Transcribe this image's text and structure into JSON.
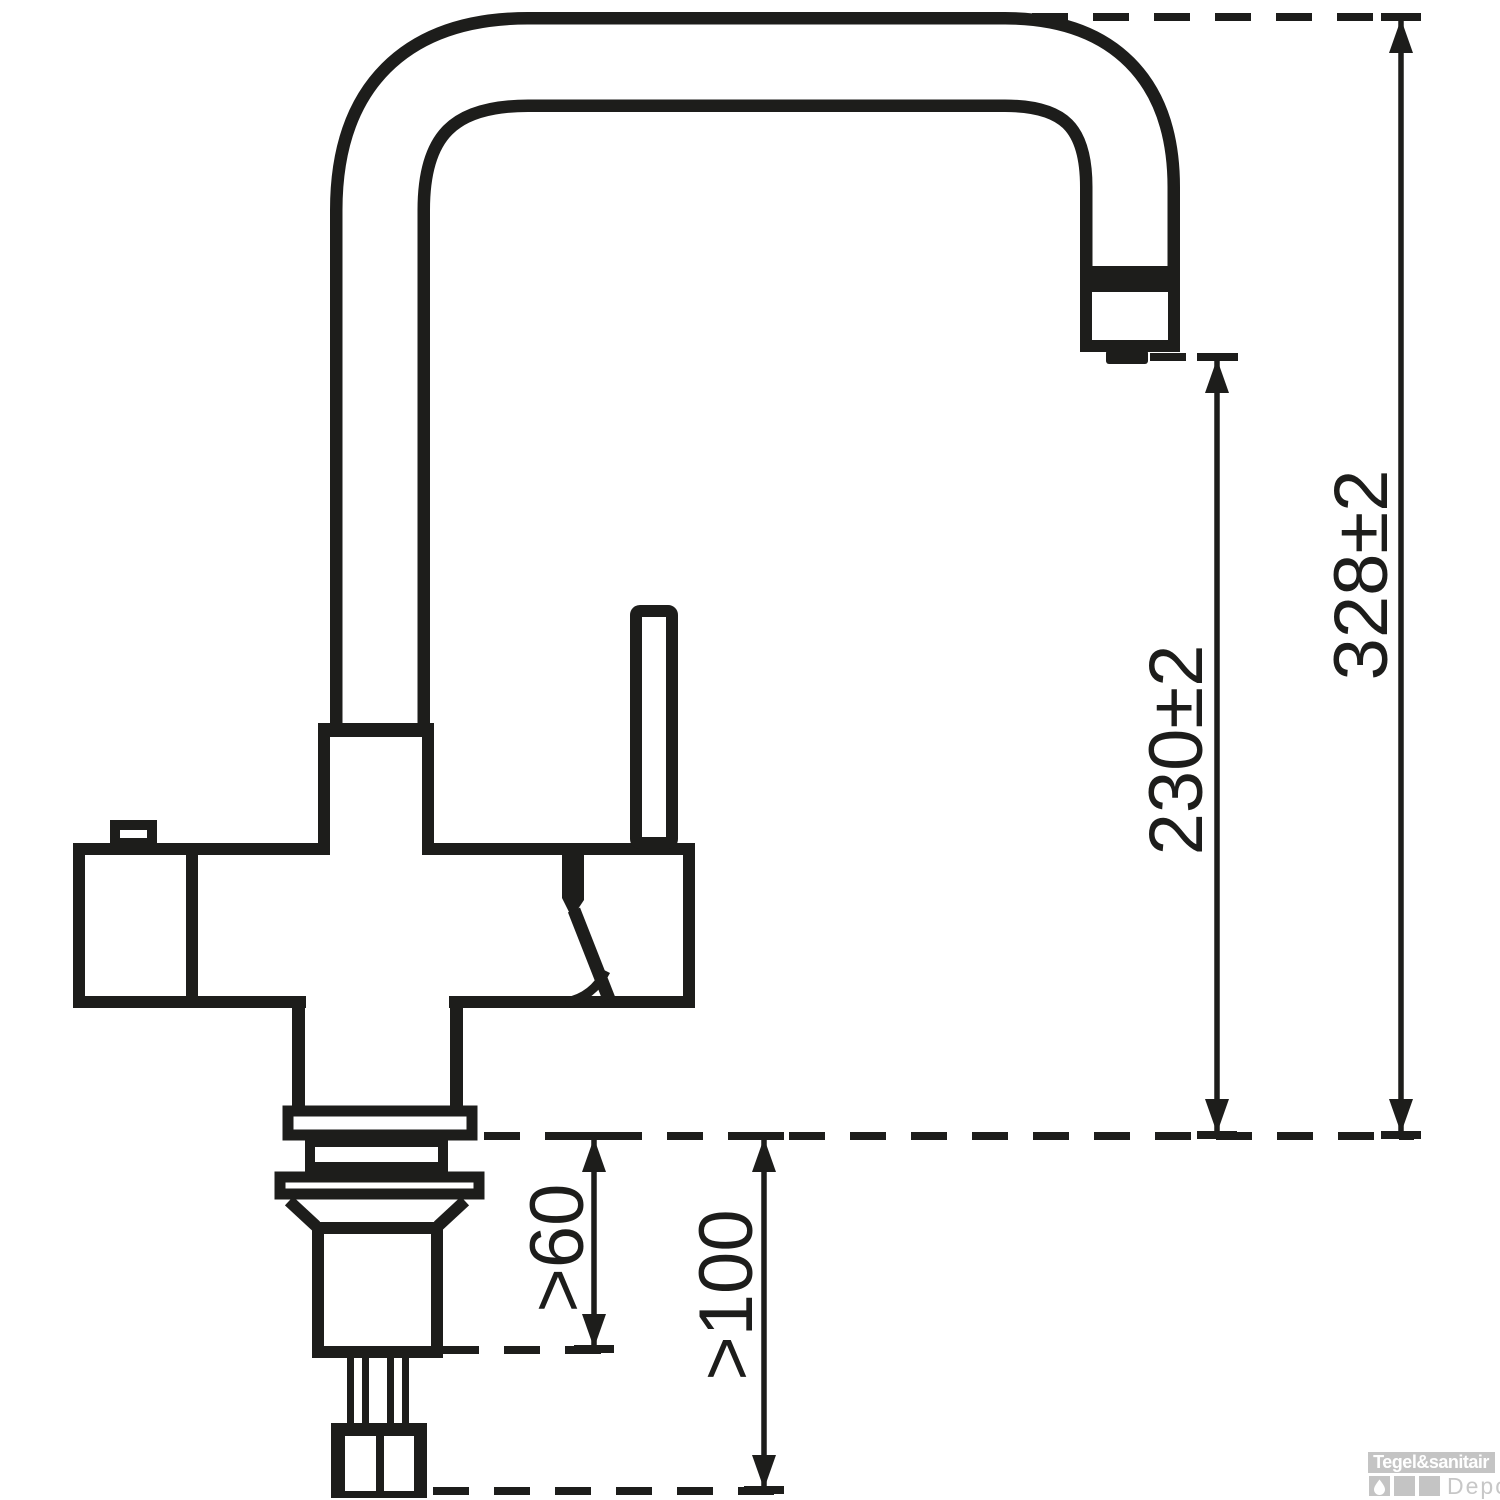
{
  "page": {
    "background": "#ffffff",
    "line_color": "#1d1d1b"
  },
  "drawing": {
    "kind": "technical dimension drawing of a kitchen mixer tap (side view)",
    "dimensions": {
      "overall_height": {
        "label": "328±2"
      },
      "spout_outlet_height": {
        "label": "230±2"
      },
      "min_depth_60": {
        "label": ">60"
      },
      "min_clearance_100": {
        "label": ">100"
      }
    }
  },
  "watermark": {
    "brand": "Tegel&sanitair",
    "suffix": "Depot",
    "banner_color": "#c4c4c4",
    "square_color": "#c4c4c4",
    "suffix_color": "#c7c7c7",
    "icon": "water-drop-icon"
  }
}
